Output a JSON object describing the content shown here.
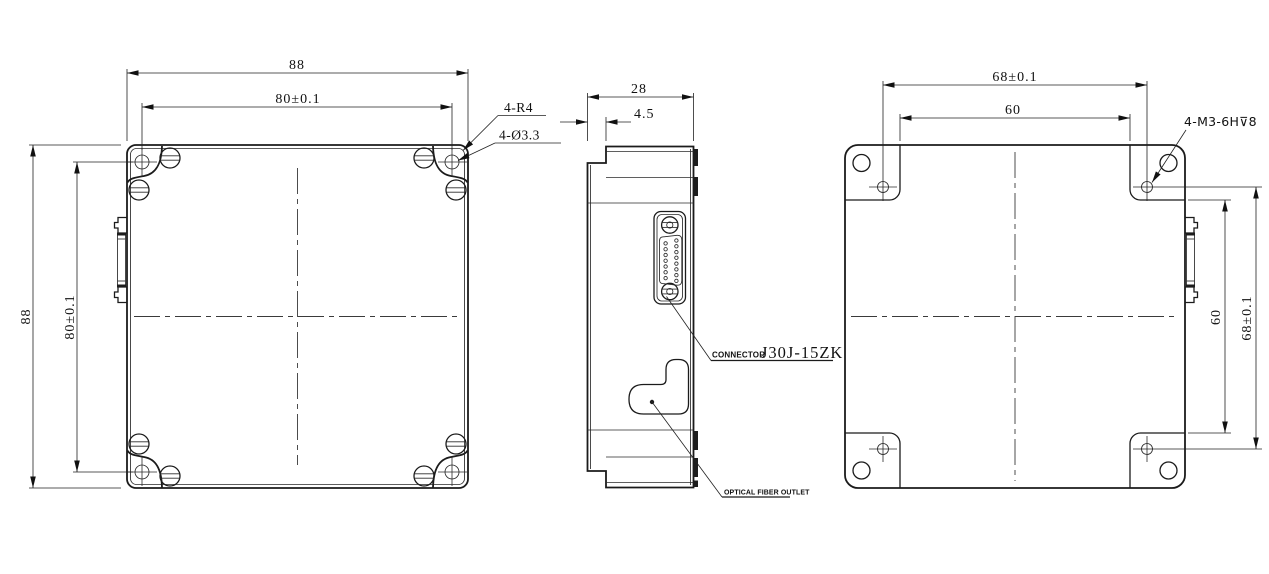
{
  "front": {
    "dim_w_outer": "88",
    "dim_w_holes": "80±0.1",
    "dim_h_outer": "88",
    "dim_h_holes": "80±0.1",
    "label_radius": "4-R4",
    "label_holes": "4-Ø3.3"
  },
  "side": {
    "dim_depth": "28",
    "dim_step": "4.5",
    "connector_prefix": "CONNECTOR",
    "connector_part": "J30J-15ZK",
    "fiber_outlet": "OPTICAL FIBER OUTLET"
  },
  "back": {
    "dim_w_holes": "68±0.1",
    "dim_w_pads": "60",
    "dim_h_pads": "60",
    "dim_h_holes": "68±0.1",
    "label_thread": "4-M3-6H⊽8"
  }
}
